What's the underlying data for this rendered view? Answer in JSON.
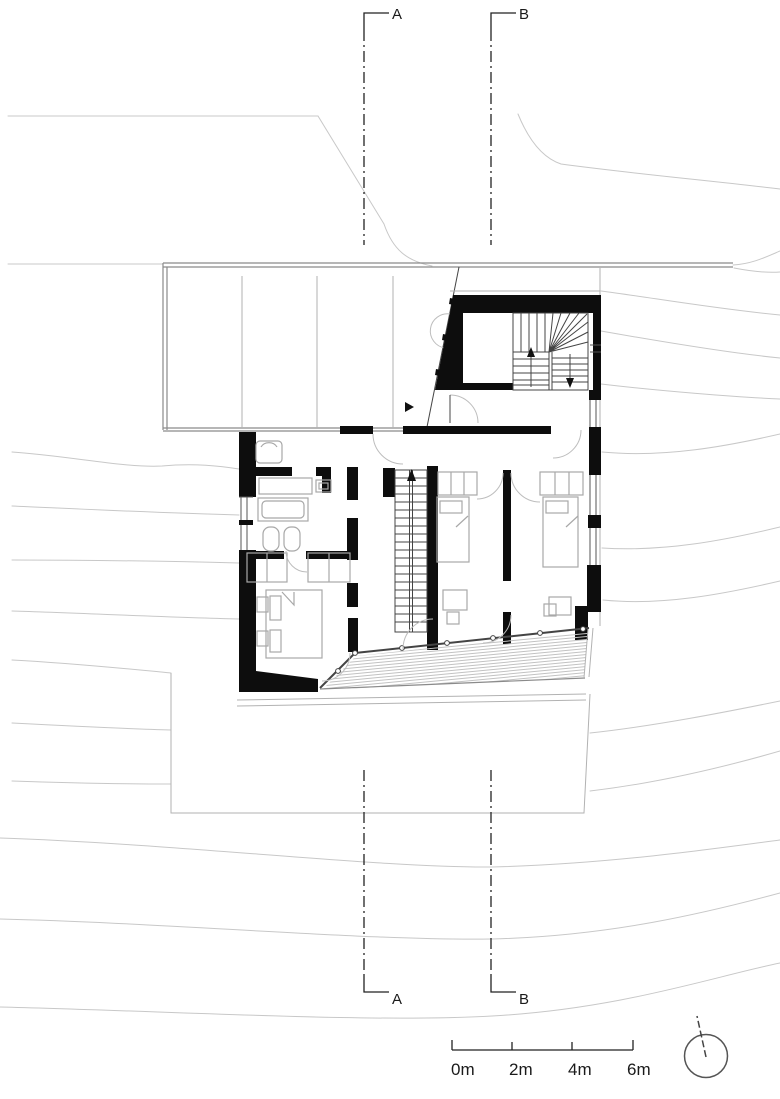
{
  "drawing_labels": {
    "section_a": "A",
    "section_b": "B"
  },
  "scale_bar": {
    "labels": [
      "0m",
      "2m",
      "4m",
      "6m"
    ]
  },
  "icons": {
    "north_indicator": "compass-circle-icon",
    "entry_marker": "entry-arrow-icon",
    "stair_up": "arrow-up-icon",
    "stair_down": "arrow-down-icon"
  },
  "colors": {
    "wall": "#0d0d0d",
    "outline": "#8a8a8a",
    "contour": "#c8c8c8",
    "text": "#1a1a1a",
    "furniture": "#a8a8a8",
    "deck": "#c2c2c2"
  }
}
